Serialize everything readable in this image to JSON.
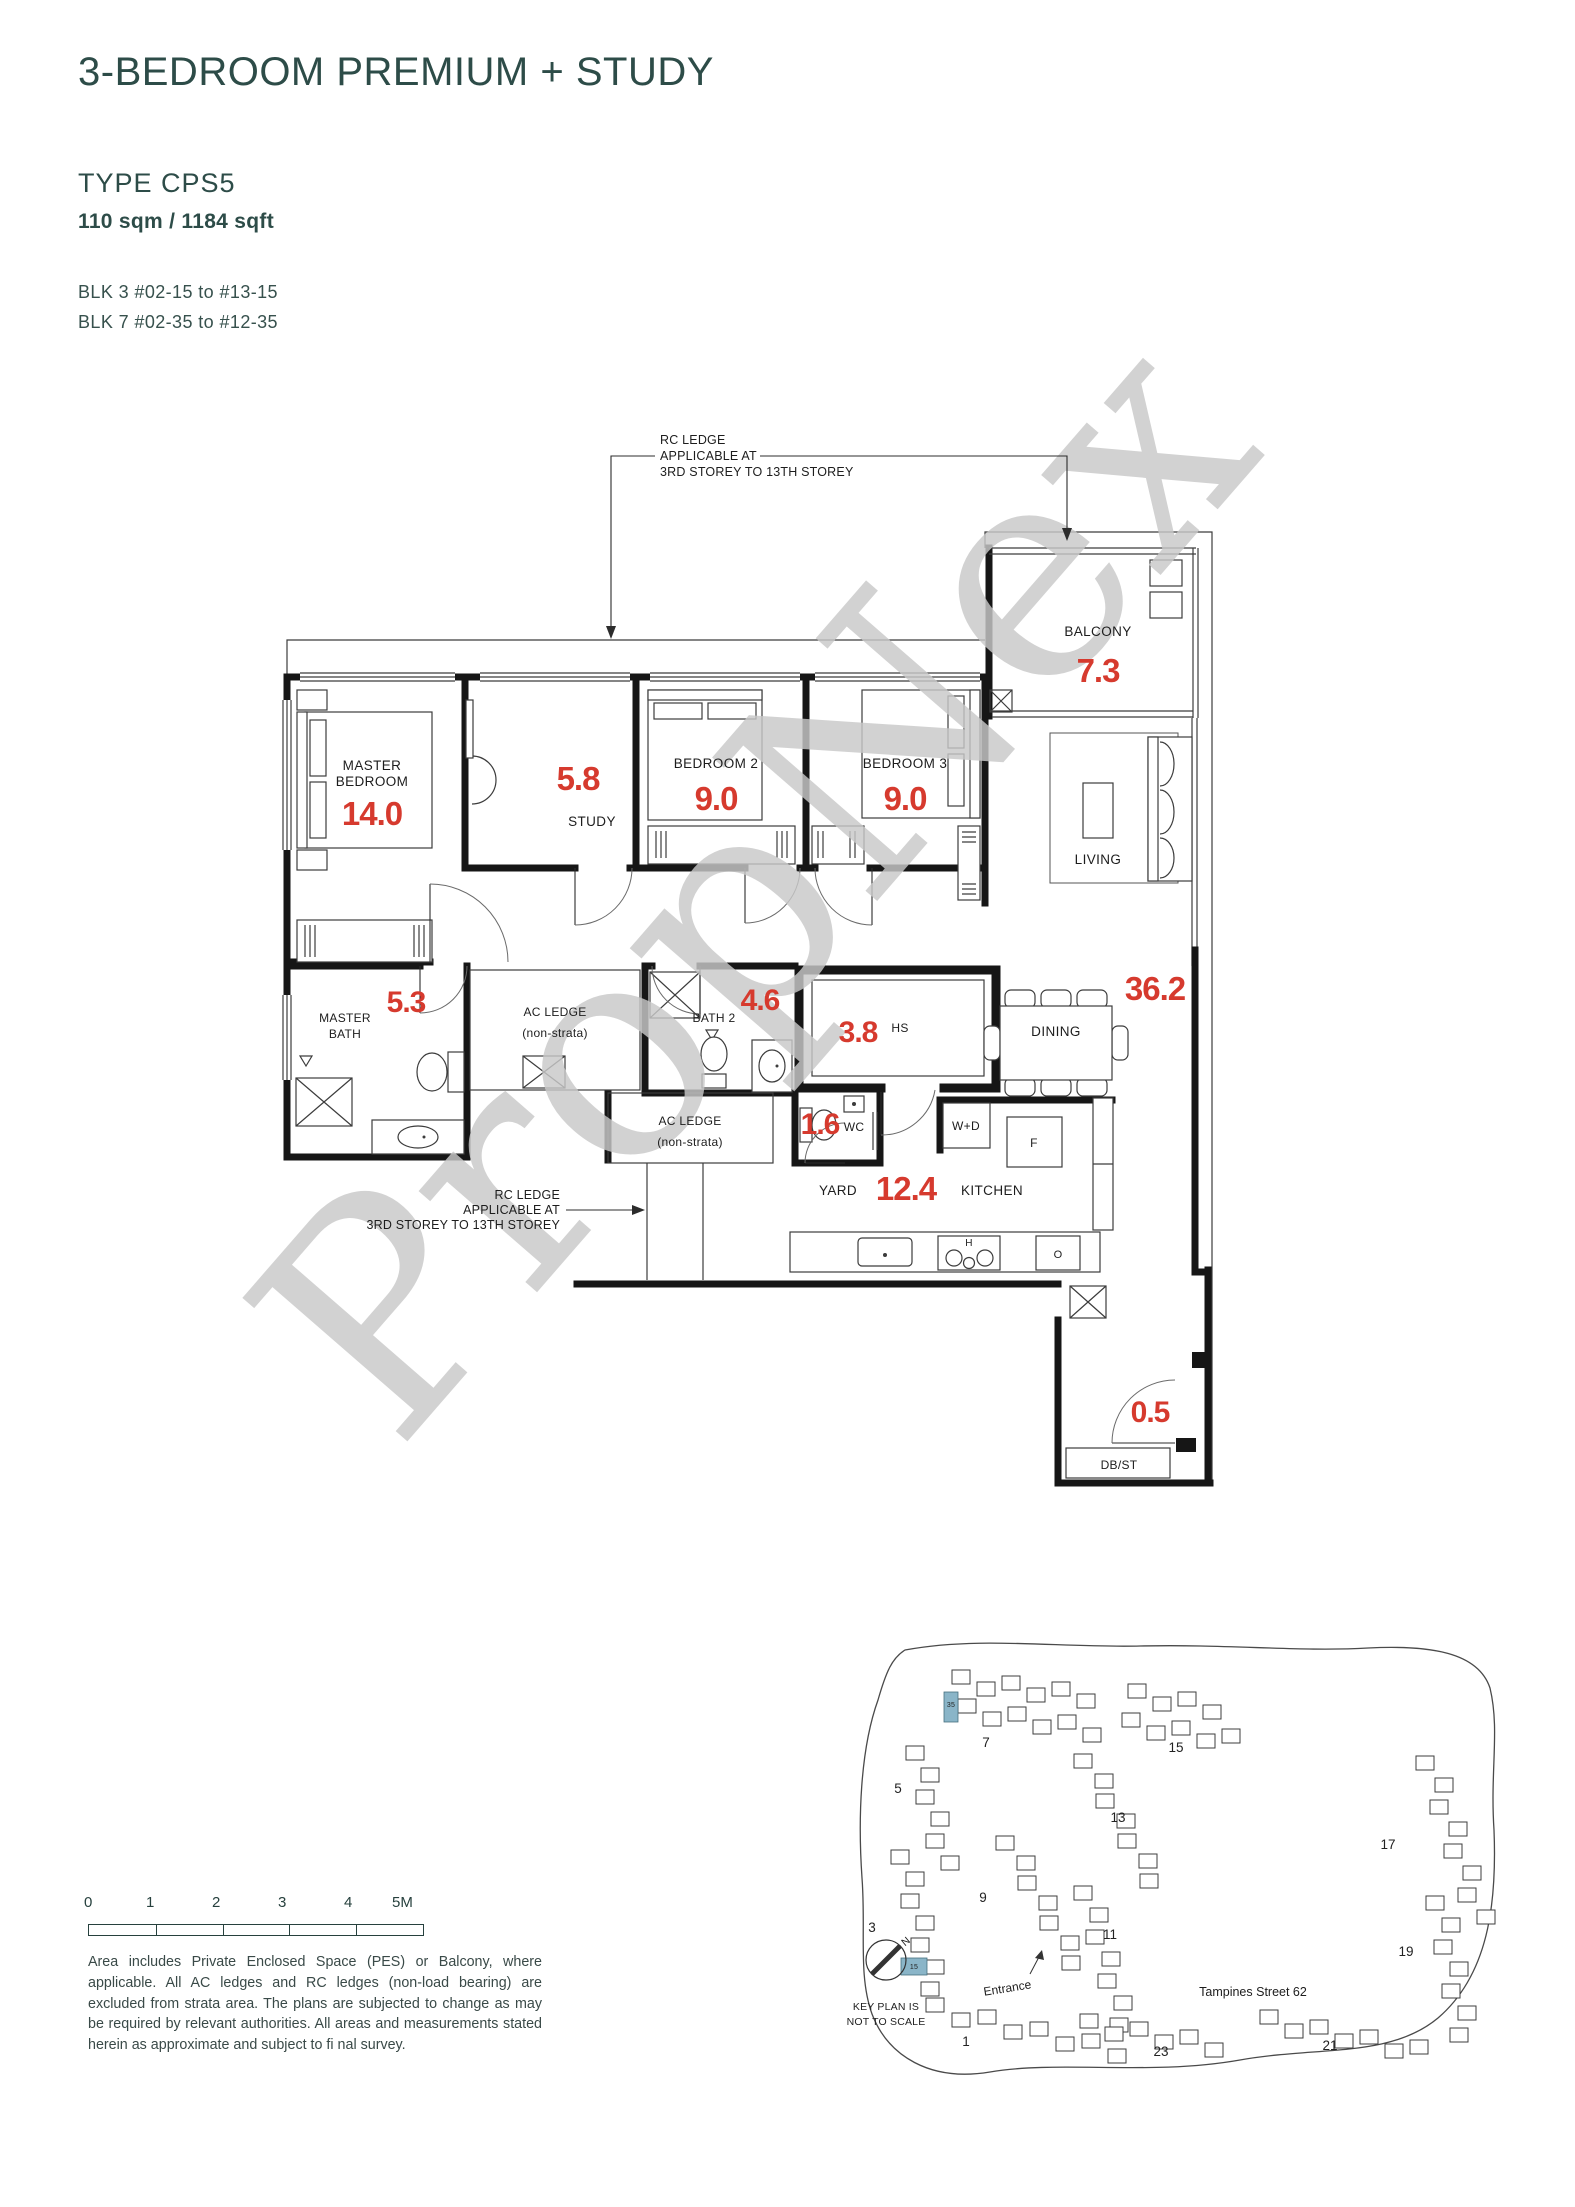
{
  "header": {
    "title": "3-BEDROOM PREMIUM + STUDY",
    "type_label": "TYPE CPS5",
    "area_label": "110 sqm / 1184 sqft",
    "blk_line1": "BLK 3 #02-15 to #13-15",
    "blk_line2": "BLK 7 #02-35 to #12-35"
  },
  "watermark": "PropNex",
  "colors": {
    "heading": "#2d4c48",
    "area_red": "#d63a2e",
    "wall": "#161616",
    "keyplan_highlight": "#8ab5c8",
    "watermark_gray": "#c9c9c9"
  },
  "floorplan": {
    "annotation_top": {
      "line1": "RC LEDGE",
      "line2": "APPLICABLE AT",
      "line3": "3RD STOREY TO 13TH STOREY"
    },
    "annotation_left": {
      "line1": "RC LEDGE",
      "line2": "APPLICABLE AT",
      "line3": "3RD STOREY TO 13TH STOREY"
    },
    "rooms": {
      "master_bedroom": {
        "line1": "MASTER",
        "line2": "BEDROOM",
        "area": "14.0"
      },
      "study": {
        "label": "STUDY",
        "area": "5.8"
      },
      "bedroom2": {
        "label": "BEDROOM 2",
        "area": "9.0"
      },
      "bedroom3": {
        "label": "BEDROOM 3",
        "area": "9.0"
      },
      "balcony": {
        "label": "BALCONY",
        "area": "7.3"
      },
      "living": {
        "label": "LIVING"
      },
      "dining": {
        "label": "DINING"
      },
      "living_dining_area": "36.2",
      "master_bath": {
        "line1": "MASTER",
        "line2": "BATH",
        "area": "5.3"
      },
      "ac_ledge_upper": {
        "line1": "AC LEDGE",
        "line2": "(non-strata)"
      },
      "bath2": {
        "label": "BATH 2",
        "area": "4.6"
      },
      "household_shelter": {
        "label": "HS",
        "area": "3.8"
      },
      "wc": {
        "label": "WC",
        "area": "1.6"
      },
      "ac_ledge_lower": {
        "line1": "AC LEDGE",
        "line2": "(non-strata)"
      },
      "yard": {
        "label": "YARD"
      },
      "kitchen": {
        "label": "KITCHEN",
        "area": "12.4"
      },
      "foyer_area": "0.5",
      "db_st": "DB/ST"
    },
    "appliances": {
      "washer_dryer": "W+D",
      "fridge": "F",
      "hob": "H",
      "oven": "O"
    }
  },
  "scalebar": {
    "ticks": [
      "0",
      "1",
      "2",
      "3",
      "4",
      "5M"
    ]
  },
  "disclaimer": "Area includes Private Enclosed Space (PES) or Balcony, where applicable. All AC ledges and RC ledges (non-load bearing) are excluded from strata area. The plans are subjected to change as may be required by relevant authorities. All areas and measurements stated herein as approximate and subject to fi nal survey.",
  "keyplan": {
    "north_label": "N",
    "caption_line1": "KEY PLAN IS",
    "caption_line2": "NOT TO SCALE",
    "entrance_label": "Entrance",
    "street_label": "Tampines Street 62",
    "blocks": [
      {
        "label": "1"
      },
      {
        "label": "3"
      },
      {
        "label": "5"
      },
      {
        "label": "7"
      },
      {
        "label": "9"
      },
      {
        "label": "11"
      },
      {
        "label": "13"
      },
      {
        "label": "15"
      },
      {
        "label": "17"
      },
      {
        "label": "19"
      },
      {
        "label": "21"
      },
      {
        "label": "23"
      }
    ],
    "highlight_stacks": [
      {
        "label": "35"
      },
      {
        "label": "15"
      }
    ],
    "clusters": [
      {
        "x": 952,
        "y": 1670,
        "dx": 25,
        "dy": 3,
        "n": 6,
        "alt": 9
      },
      {
        "x": 958,
        "y": 1699,
        "dx": 25,
        "dy": 4,
        "n": 6,
        "alt": 9
      },
      {
        "x": 1128,
        "y": 1684,
        "dx": 25,
        "dy": 4,
        "n": 4,
        "alt": 9
      },
      {
        "x": 1122,
        "y": 1713,
        "dx": 25,
        "dy": 4,
        "n": 5,
        "alt": 9
      },
      {
        "x": 906,
        "y": 1746,
        "dx": 5,
        "dy": 22,
        "n": 6,
        "alt": 10
      },
      {
        "x": 891,
        "y": 1850,
        "dx": 5,
        "dy": 22,
        "n": 7,
        "alt": 10
      },
      {
        "x": 996,
        "y": 1836,
        "dx": 11,
        "dy": 20,
        "n": 7,
        "alt": 10
      },
      {
        "x": 1074,
        "y": 1754,
        "dx": 11,
        "dy": 20,
        "n": 7,
        "alt": 10
      },
      {
        "x": 1074,
        "y": 1886,
        "dx": 6,
        "dy": 22,
        "n": 7,
        "alt": 10
      },
      {
        "x": 1416,
        "y": 1756,
        "dx": 7,
        "dy": 22,
        "n": 8,
        "alt": 12
      },
      {
        "x": 1426,
        "y": 1896,
        "dx": 4,
        "dy": 22,
        "n": 7,
        "alt": 12
      },
      {
        "x": 1260,
        "y": 2010,
        "dx": 25,
        "dy": 5,
        "n": 7,
        "alt": 9
      },
      {
        "x": 1080,
        "y": 2014,
        "dx": 25,
        "dy": 4,
        "n": 6,
        "alt": 9
      },
      {
        "x": 926,
        "y": 1998,
        "dx": 26,
        "dy": 6,
        "n": 8,
        "alt": 9
      }
    ]
  }
}
